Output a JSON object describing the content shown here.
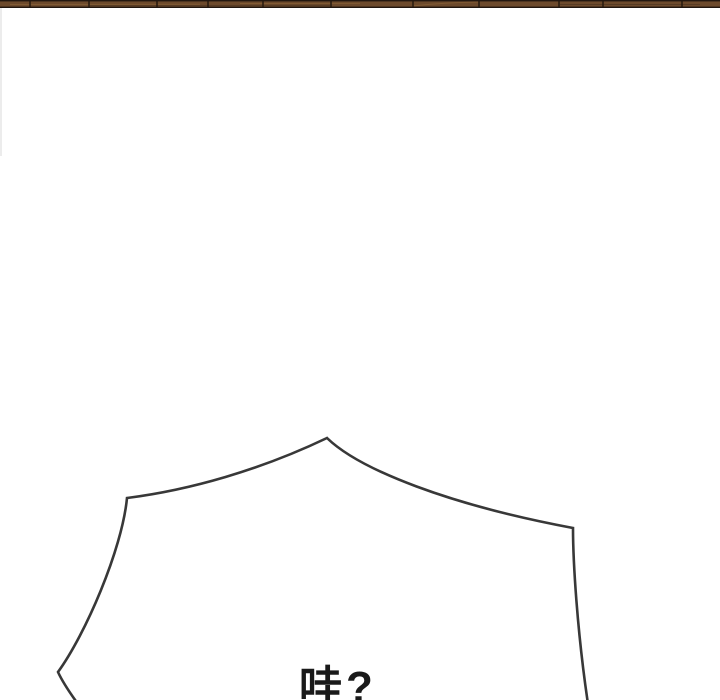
{
  "page": {
    "kind": "webtoon-comic-segment",
    "background_color": "#ffffff"
  },
  "panel_strip": {
    "description": "bottom sliver of previous comic panel: wooden plank edge",
    "base_color": "#6d4a2c",
    "right_tint_color": "#4f3c2a",
    "edge_line_color": "#221710",
    "divider_color": "#2b1d12",
    "grain_highlight_color": "#8a6238"
  },
  "speech_bubble": {
    "type": "spiky-shout-bubble",
    "outline_color": "#383838",
    "fill_color": "#ffffff",
    "text": "哇?",
    "text_color": "#1a1a1a"
  }
}
